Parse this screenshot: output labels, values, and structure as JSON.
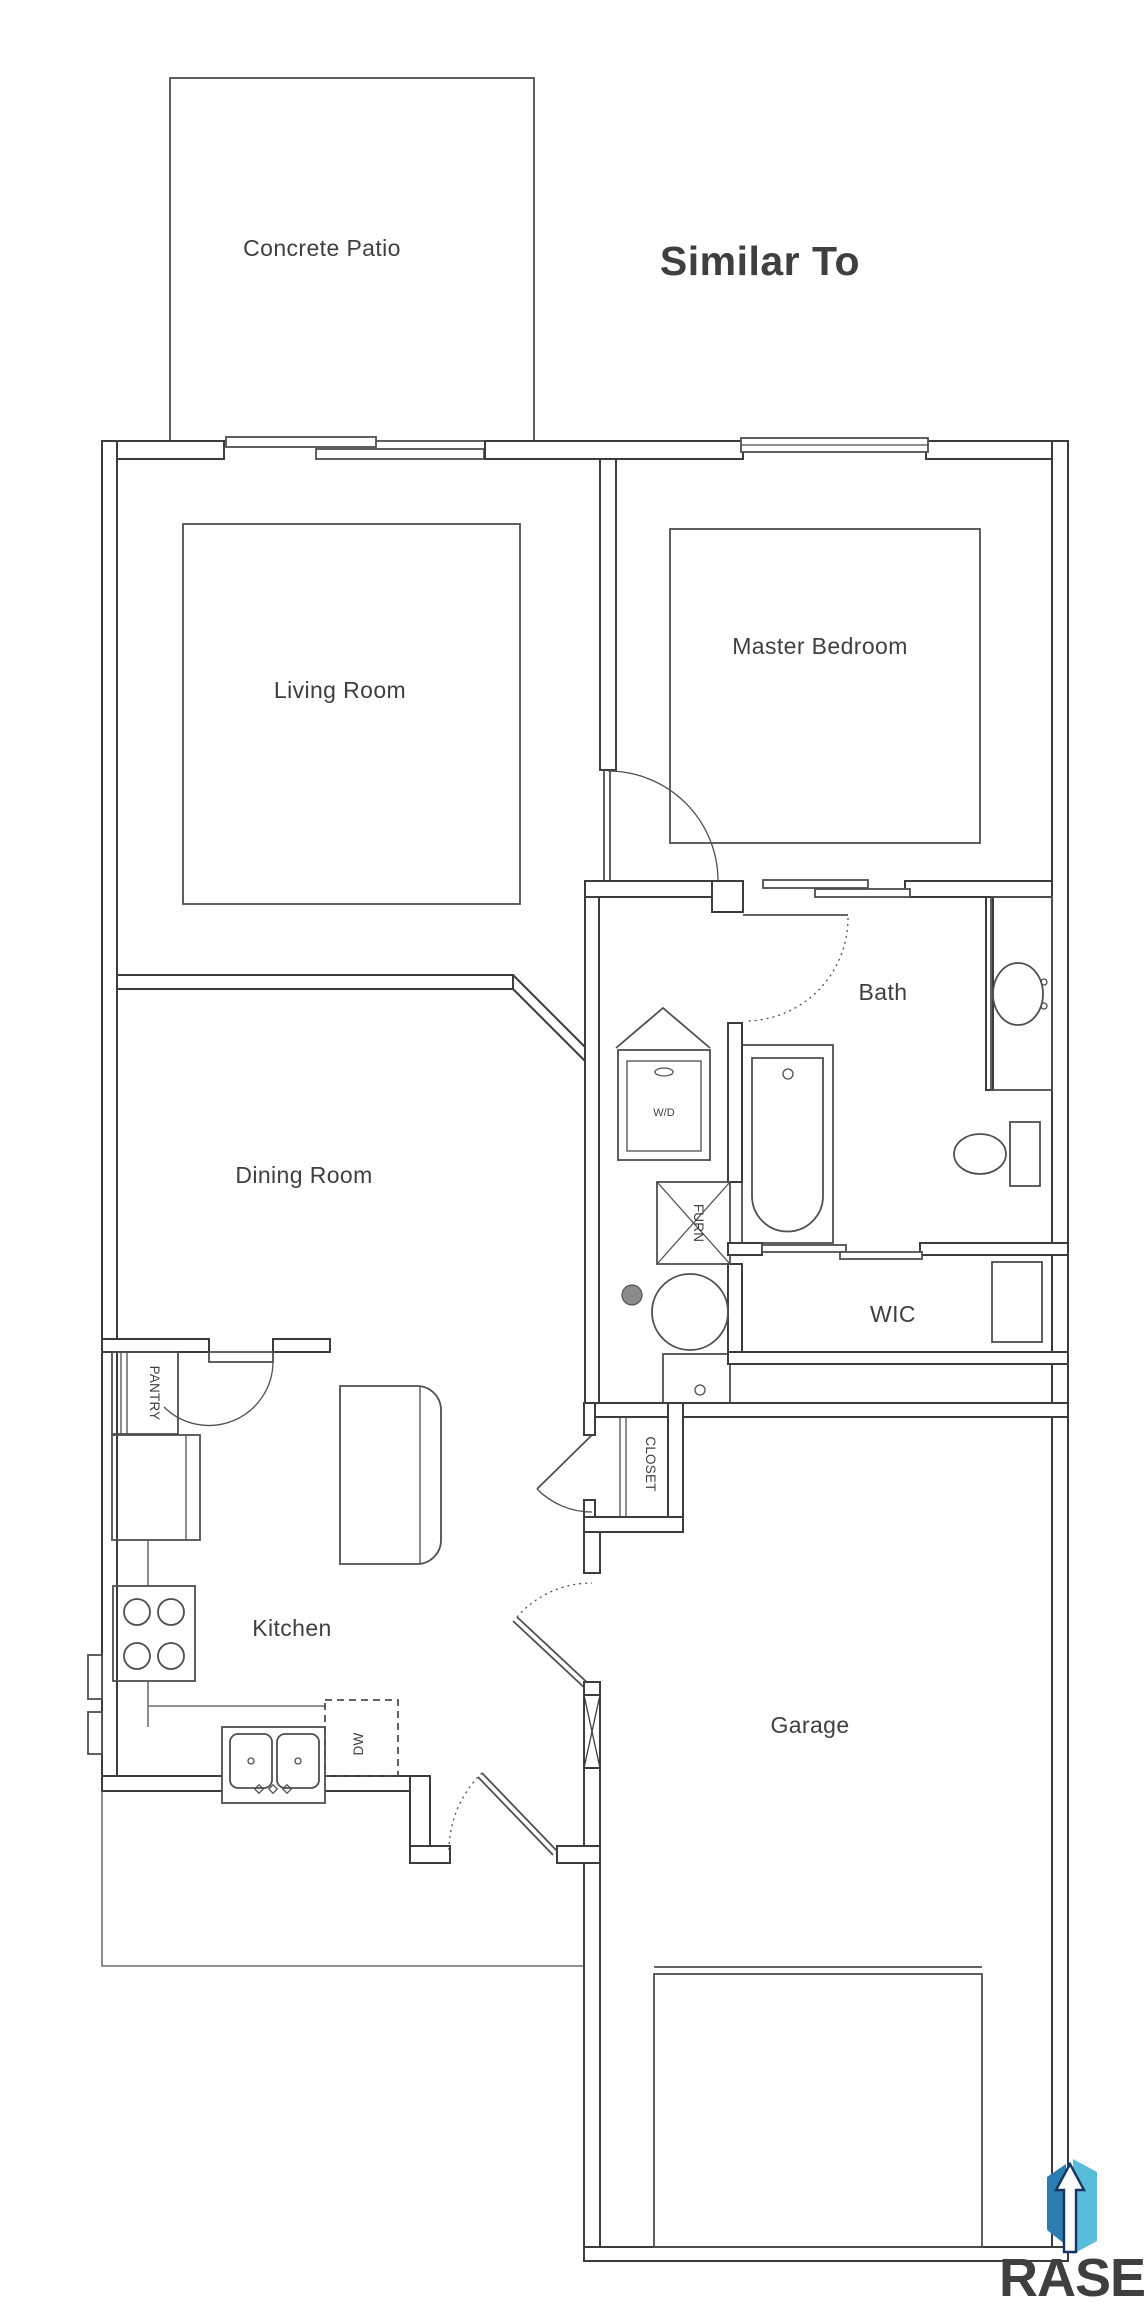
{
  "title": "Similar To",
  "brand": {
    "name": "RASE"
  },
  "labels": {
    "concrete_patio": "Concrete Patio",
    "living_room": "Living Room",
    "master_bedroom": "Master Bedroom",
    "bath": "Bath",
    "dining_room": "Dining Room",
    "wic": "WIC",
    "kitchen": "Kitchen",
    "garage": "Garage",
    "pantry": "PANTRY",
    "closet": "CLOSET",
    "furnace": "FURN",
    "dishwasher": "DW",
    "washer_dryer": "W/D"
  },
  "colors": {
    "wall_line": "#3c3c3c",
    "fixture_line": "#4f4f4f",
    "label_text": "#3f3f3f",
    "title_text": "#1a1a1a",
    "logo_navy": "#17365f",
    "logo_blue": "#2c7db2",
    "logo_teal": "#58bdda"
  }
}
